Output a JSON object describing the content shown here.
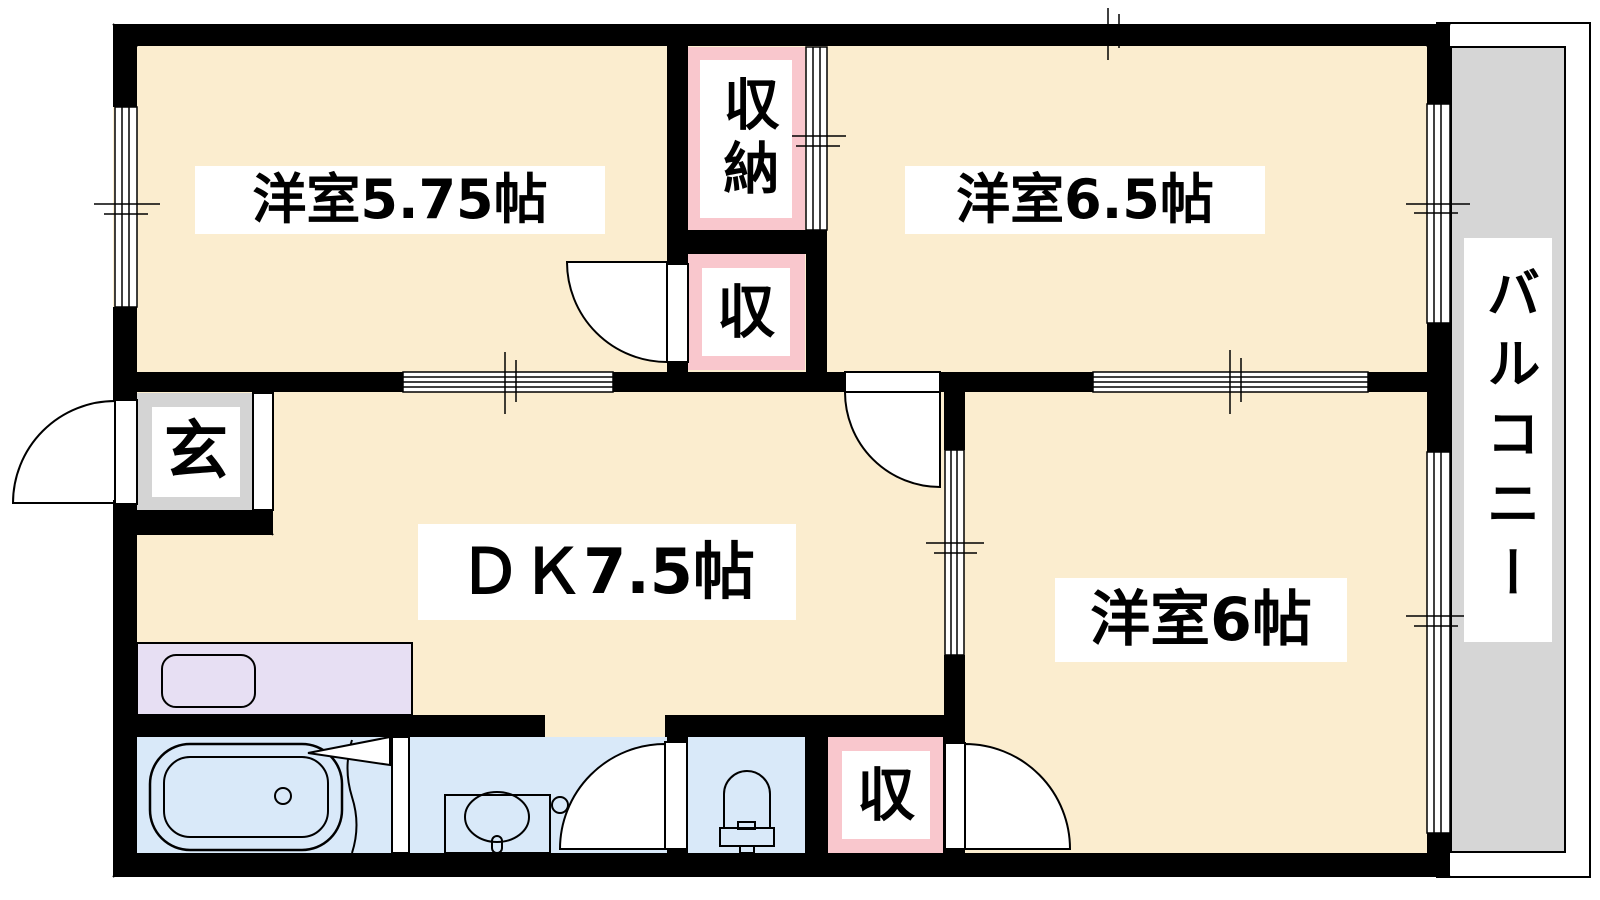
{
  "labels": {
    "room575": "洋室5.75帖",
    "room65": "洋室6.5帖",
    "dk": "ＤＫ7.5帖",
    "room6": "洋室6帖",
    "genkan": "玄",
    "shuno": "収納",
    "shuTop": "収",
    "shuBottom": "収",
    "balcony": "バルコニー"
  },
  "colors": {
    "wall": "#000000",
    "floor": "#FBEDCF",
    "closet": "#F9C7CD",
    "entry": "#D4D4D4",
    "kitchen": "#E7DFF3",
    "wet": "#D9E9F9",
    "balcony": "#D6D6D6",
    "labelBg": "#FFFFFF"
  }
}
